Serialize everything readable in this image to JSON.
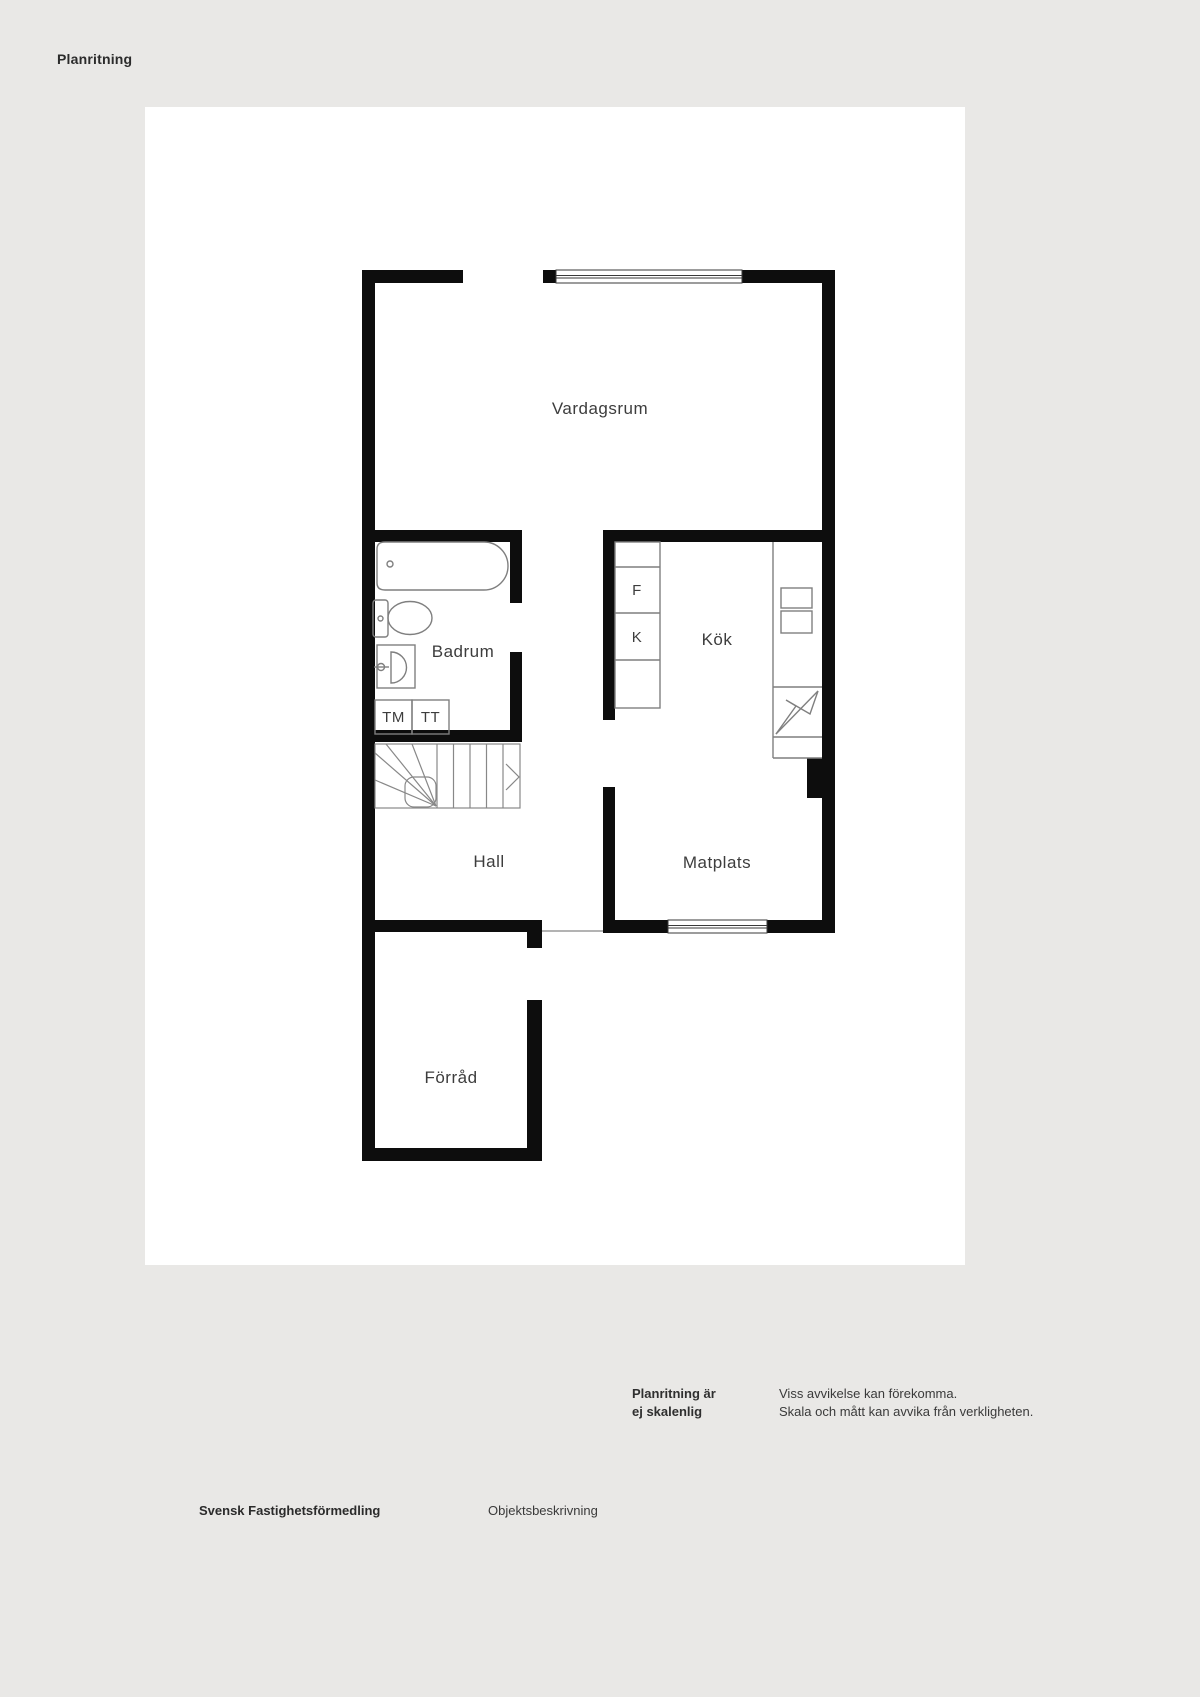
{
  "page": {
    "title": "Planritning",
    "colors": {
      "background": "#e9e8e6",
      "sheet": "#ffffff",
      "wall": "#0d0d0d",
      "fixture_line": "#7f7f7f",
      "window_line": "#3a3a3a",
      "label_text": "#3d3d3d"
    }
  },
  "rooms": {
    "vardagsrum": "Vardagsrum",
    "badrum": "Badrum",
    "kok": "Kök",
    "hall": "Hall",
    "matplats": "Matplats",
    "forrad": "Förråd"
  },
  "appliances": {
    "f": "F",
    "k": "K",
    "tm": "TM",
    "tt": "TT"
  },
  "disclaimer": {
    "scale_note_line1": "Planritning är",
    "scale_note_line2": "ej skalenlig",
    "deviation_line1": "Viss avvikelse kan förekomma.",
    "deviation_line2": "Skala och mått kan avvika från verkligheten."
  },
  "footer": {
    "brand": "Svensk Fastighetsförmedling",
    "document_type": "Objektsbeskrivning"
  }
}
